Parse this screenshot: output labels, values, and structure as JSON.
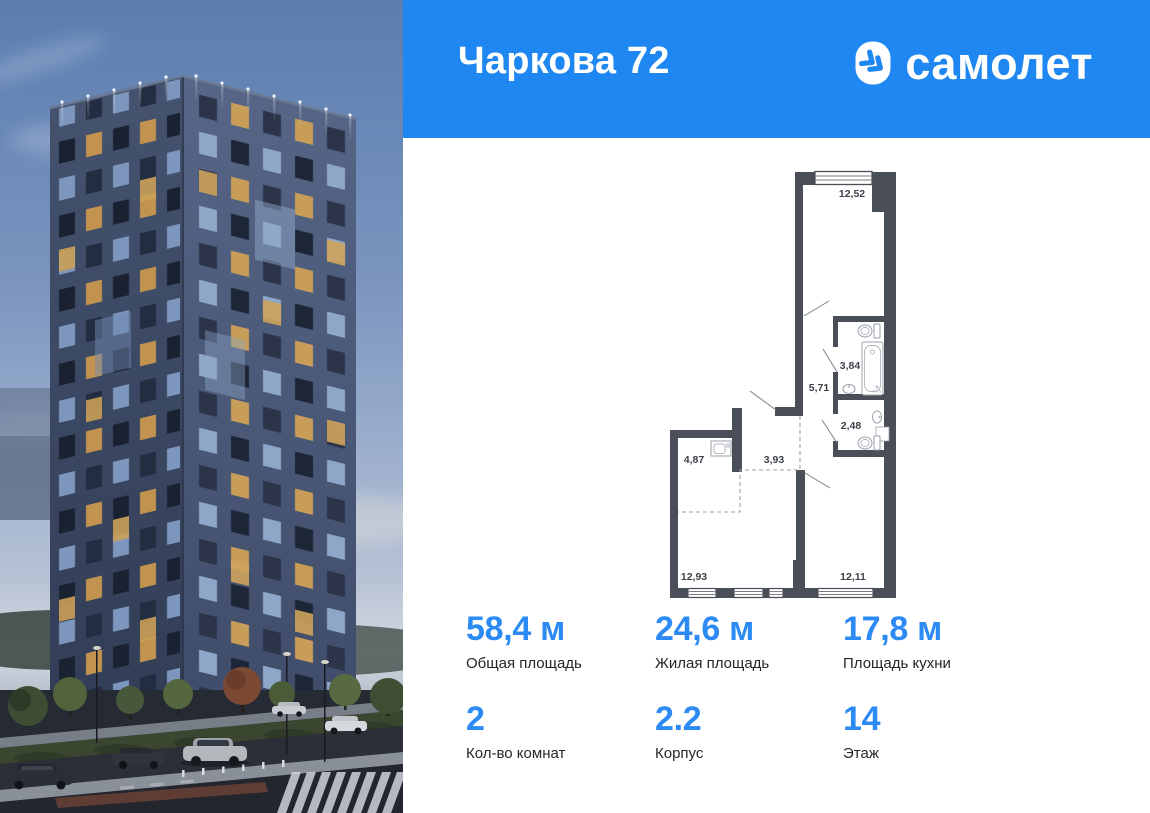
{
  "header": {
    "title": "Чаркова 72",
    "brand_name": "самолет",
    "background_color": "#1e87f2",
    "logo_icon": "samolet-chevron-icon"
  },
  "floor_plan": {
    "rooms": [
      {
        "name": "bedroom-top",
        "area": "12,52"
      },
      {
        "name": "bathroom",
        "area": "3,84"
      },
      {
        "name": "hallway",
        "area": "5,71"
      },
      {
        "name": "toilet",
        "area": "2,48"
      },
      {
        "name": "kitchen-niche",
        "area": "4,87"
      },
      {
        "name": "hall",
        "area": "3,93"
      },
      {
        "name": "living-room",
        "area": "12,93"
      },
      {
        "name": "bedroom-right",
        "area": "12,11"
      }
    ]
  },
  "stats": [
    {
      "id": "total-area",
      "value": "58,4 м",
      "label": "Общая площадь"
    },
    {
      "id": "living-area",
      "value": "24,6 м",
      "label": "Жилая площадь"
    },
    {
      "id": "kitchen-area",
      "value": "17,8 м",
      "label": "Площадь кухни"
    },
    {
      "id": "rooms-count",
      "value": "2",
      "label": "Кол-во комнат"
    },
    {
      "id": "building",
      "value": "2.2",
      "label": "Корпус"
    },
    {
      "id": "floor",
      "value": "14",
      "label": "Этаж"
    }
  ],
  "colors": {
    "header_blue": "#1e87f2",
    "stat_blue": "#2b8af3",
    "plan_wall": "#4a4e56",
    "text_dark": "#23262c"
  }
}
